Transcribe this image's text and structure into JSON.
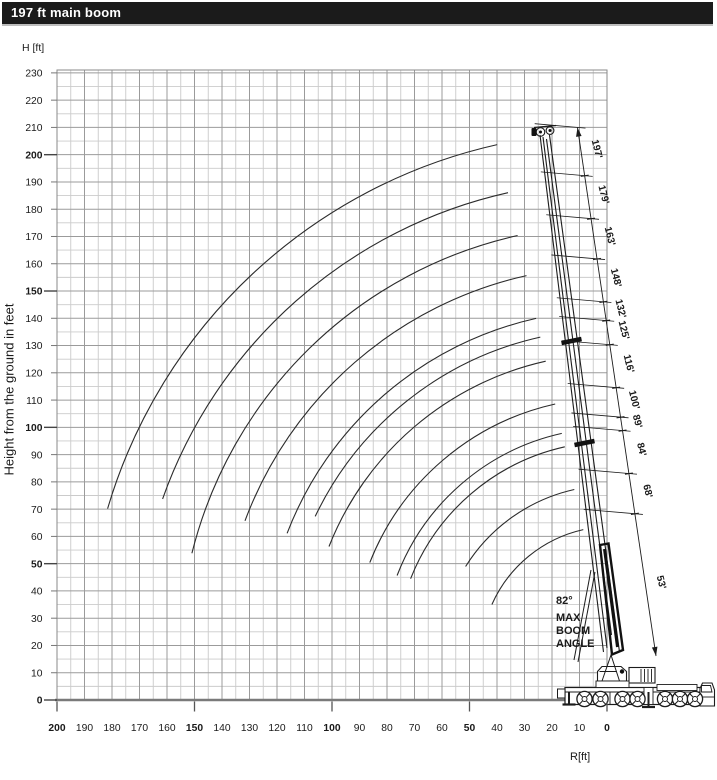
{
  "title_bar": {
    "title": "197 ft main boom"
  },
  "max_boom_angle": {
    "deg": "82°",
    "l1": "MAX",
    "l2": "BOOM",
    "l3": "ANGLE"
  },
  "chart_data": {
    "type": "line",
    "title": "197 ft main boom",
    "description": "Crane working-range diagram: hook height H versus working radius R for each telescopic main-boom length; arcs swept about the boom pivot from minimum angle up to near the 82 degree maximum boom angle",
    "x_axis": {
      "label": "R[ft]",
      "min": 0,
      "max": 200,
      "tick_step": 10,
      "reversed": true,
      "bold_ticks": [
        0,
        50,
        100,
        150,
        200
      ],
      "ticks": [
        200,
        190,
        180,
        170,
        160,
        150,
        140,
        130,
        120,
        110,
        100,
        90,
        80,
        70,
        60,
        50,
        40,
        30,
        20,
        10,
        0
      ]
    },
    "y_axis": {
      "header": "H [ft]",
      "label": "Height from the ground in feet",
      "min": 0,
      "max": 230,
      "tick_step": 10,
      "bold_ticks": [
        0,
        50,
        100,
        150,
        200
      ],
      "ticks": [
        230,
        220,
        210,
        200,
        190,
        180,
        170,
        160,
        150,
        140,
        130,
        120,
        110,
        100,
        90,
        80,
        70,
        60,
        50,
        40,
        30,
        20,
        10,
        0
      ]
    },
    "grid": {
      "minor_step_ft": 5,
      "major_step_ft": 10
    },
    "boom_pivot": {
      "r_ft": -2,
      "h_ft": 15
    },
    "max_boom_angle_deg": 82,
    "series": [
      {
        "label": "53'",
        "length_ft": 53,
        "min_angle_deg": 24,
        "max_angle_deg": 77.4
      },
      {
        "label": "68'",
        "length_ft": 68,
        "min_angle_deg": 32,
        "max_angle_deg": 77.4
      },
      {
        "label": "84'",
        "length_ft": 84,
        "min_angle_deg": 21.5,
        "max_angle_deg": 77.4
      },
      {
        "label": "89'",
        "length_ft": 89,
        "min_angle_deg": 21,
        "max_angle_deg": 77.4
      },
      {
        "label": "100'",
        "length_ft": 100,
        "min_angle_deg": 21.5,
        "max_angle_deg": 77.4
      },
      {
        "label": "116'",
        "length_ft": 116,
        "min_angle_deg": 21.5,
        "max_angle_deg": 77.4
      },
      {
        "label": "125'",
        "length_ft": 125,
        "min_angle_deg": 25.5,
        "max_angle_deg": 77.4
      },
      {
        "label": "132'",
        "length_ft": 132,
        "min_angle_deg": 21,
        "max_angle_deg": 77.4
      },
      {
        "label": "148'",
        "length_ft": 148,
        "min_angle_deg": 20.5,
        "max_angle_deg": 77.4
      },
      {
        "label": "163'",
        "length_ft": 163,
        "min_angle_deg": 14,
        "max_angle_deg": 77.4
      },
      {
        "label": "179'",
        "length_ft": 179,
        "min_angle_deg": 19.5,
        "max_angle_deg": 77.4
      },
      {
        "label": "197'",
        "length_ft": 197,
        "min_angle_deg": 16.5,
        "max_angle_deg": 77.4
      }
    ]
  }
}
